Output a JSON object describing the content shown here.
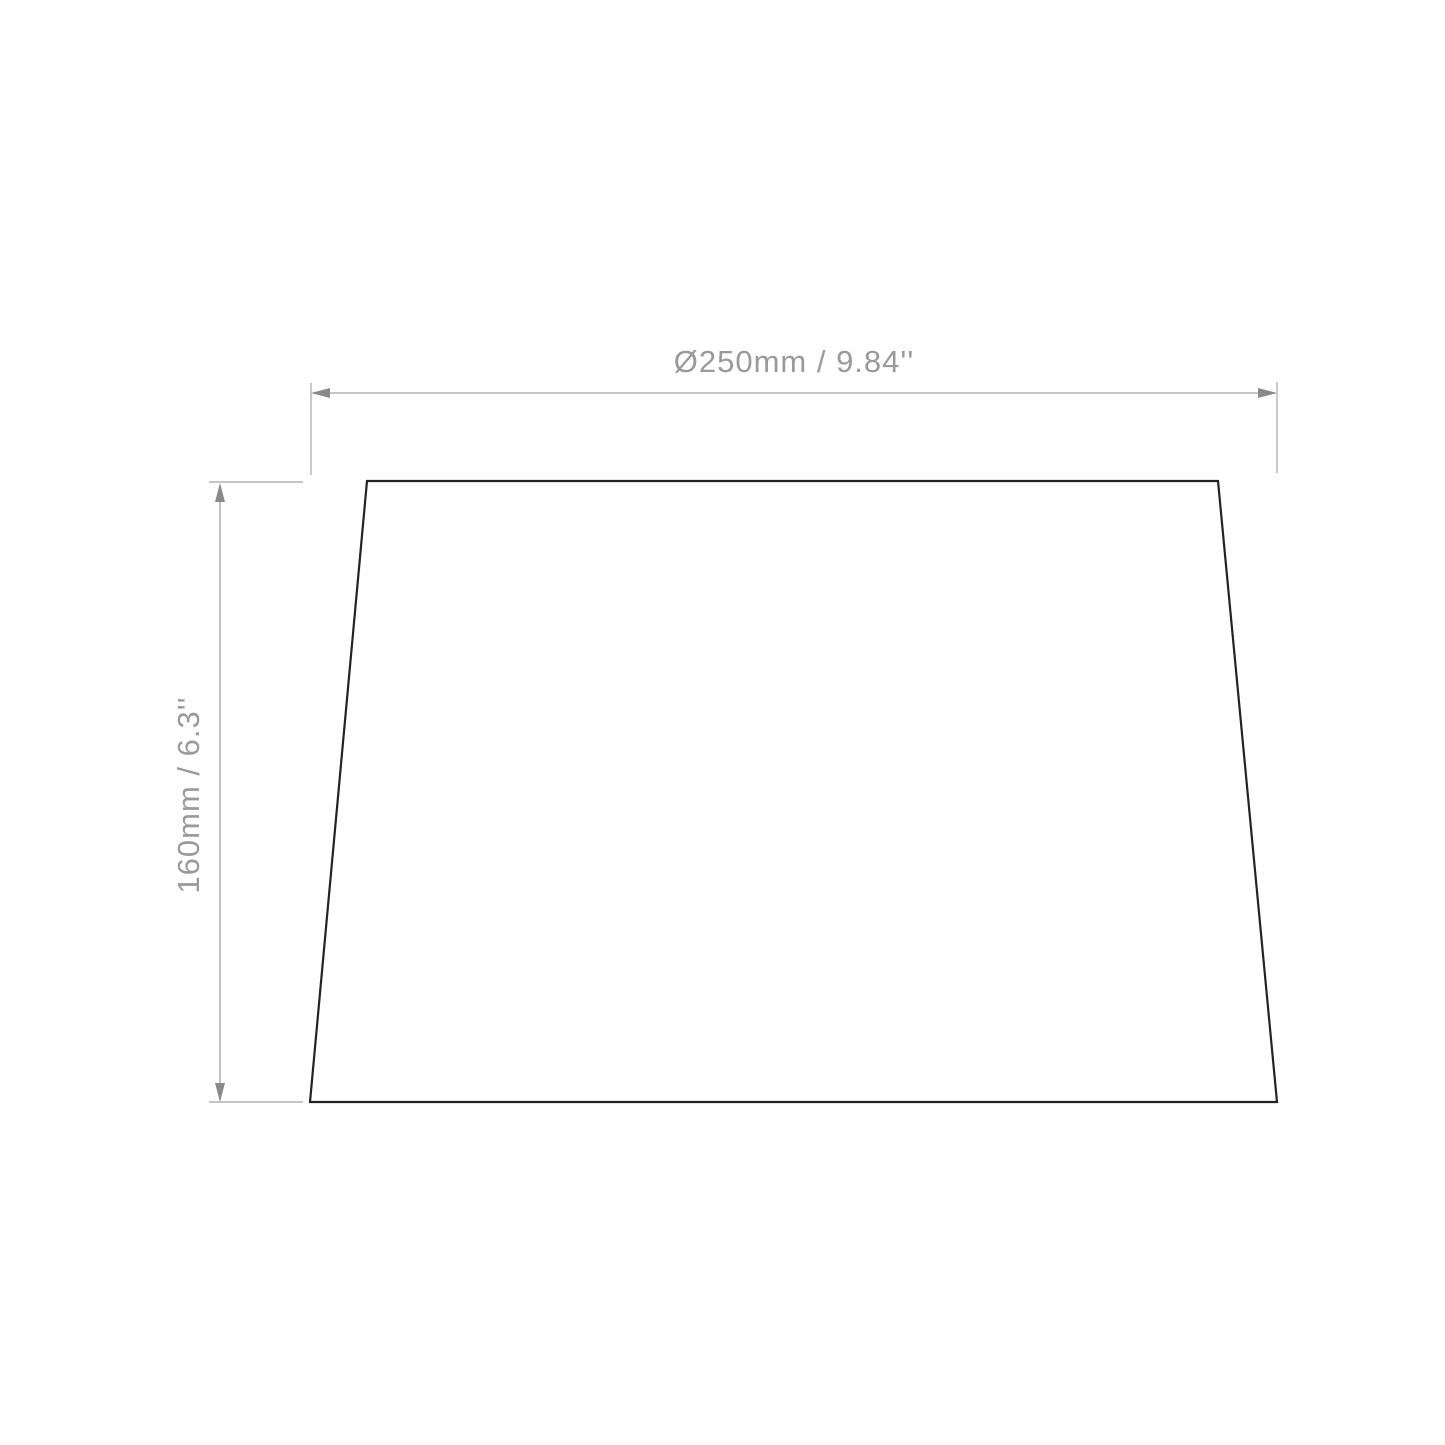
{
  "diagram": {
    "type": "technical-dimension-drawing",
    "subject": "tapered-lampshade-front-elevation",
    "width_dimension": {
      "label": "Ø250mm / 9.84''",
      "value_mm": 250,
      "value_in": 9.84
    },
    "height_dimension": {
      "label": "160mm / 6.3''",
      "value_mm": 160,
      "value_in": 6.3
    }
  },
  "colors": {
    "background": "#ffffff",
    "dimension_line": "#b4b4b4",
    "extension_line": "#b4b4b4",
    "arrow": "#8a8a8a",
    "dimension_text": "#9a9a9a",
    "shape_stroke": "#232323"
  }
}
